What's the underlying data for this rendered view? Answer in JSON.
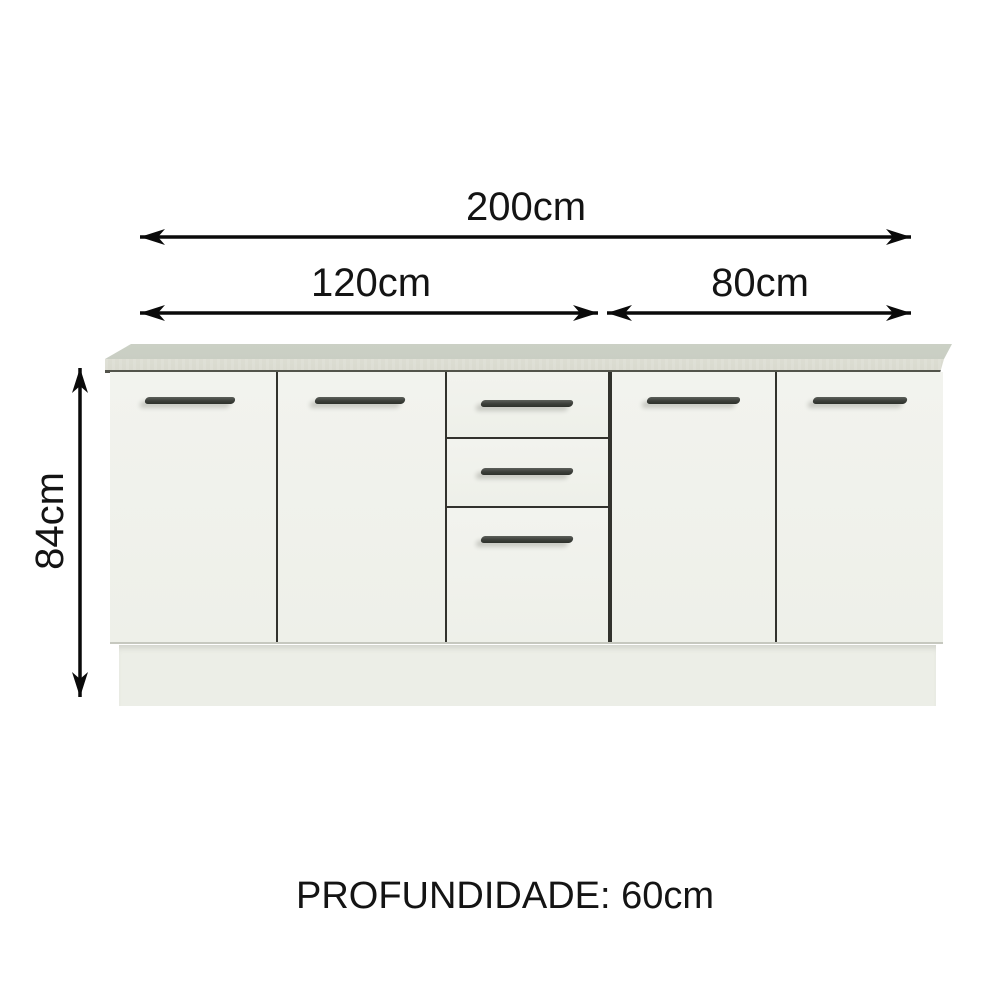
{
  "page": {
    "background": "#ffffff"
  },
  "dimension_labels": {
    "total_width": "200cm",
    "left_section_width": "120cm",
    "right_section_width": "80cm",
    "height": "84cm",
    "depth": "PROFUNDIDADE: 60cm"
  },
  "cabinet": {
    "left_doors": 2,
    "middle_drawers": 3,
    "right_doors": 2,
    "handle_count": 7
  },
  "colors": {
    "background": "#ffffff",
    "text": "#141414",
    "arrow": "#0a0a0a",
    "countertop_top": "#c9cec3",
    "countertop_edge": "#d9dacf",
    "countertop_line": "#53544b",
    "door_face": "#f1f2ec",
    "plinth": "#eceee7",
    "divider": "#32322d",
    "handle_dark": "#3c3f3a",
    "handle_light": "#5d605b",
    "shadow": "#c6c8bf"
  }
}
